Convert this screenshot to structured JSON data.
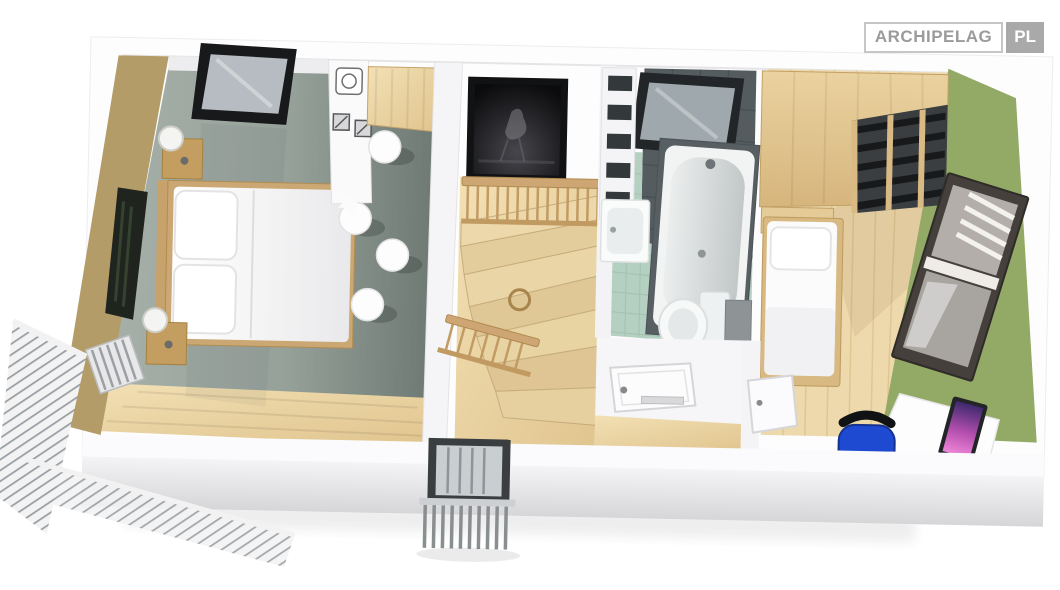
{
  "logo": {
    "brand": "ARCHIPELAG",
    "tld": "PL"
  },
  "palette": {
    "white_wall": "#fbfbfc",
    "tan_wall": "#b49c69",
    "olive_wall": "#93a966",
    "carpet_grey": "#8f9a93",
    "pine_wood": "#e8d2a2",
    "bath_floor_mint": "#b4d0c1",
    "bath_tile_dark": "#545c5f",
    "skylight_frame": "#17191b",
    "chair_blue": "#1d4ad1",
    "screen_pink": "#c45ab8",
    "logo_text_grey": "#9b9b9b",
    "logo_badge_grey": "#a9a9a9"
  },
  "scene": {
    "type": "3d-floorplan-cutaway-render",
    "view": "top-down, slight clockwise tilt",
    "rooms": [
      {
        "id": "bedroom-left",
        "label": "bedroom with dining nook",
        "objects": [
          "double bed",
          "two nightstands with lamps",
          "wall art",
          "radiator",
          "kitchenette counter with sink and hob",
          "wooden wall table",
          "white stools",
          "roof skylight",
          "grey carpet",
          "pine floor border"
        ]
      },
      {
        "id": "stair-hall",
        "label": "landing with winder staircase",
        "objects": [
          "framed artwork",
          "wooden railing",
          "winder stairs",
          "glazed balcony door"
        ]
      },
      {
        "id": "bathroom",
        "label": "bathroom",
        "objects": [
          "bathtub",
          "washbasin",
          "toilet",
          "towel shelf",
          "roof skylight",
          "mint floor tiles",
          "dark wall tiles",
          "door"
        ]
      },
      {
        "id": "bedroom-right",
        "label": "bedroom / study",
        "objects": [
          "wardrobe with open shelves",
          "single bed",
          "tilted window with blinds",
          "desk with monitor",
          "blue office chair",
          "door"
        ]
      }
    ],
    "exterior": [
      "white perimeter walls",
      "corner balcony with slatted railing",
      "juliet balcony railing",
      "soft drop shadow"
    ]
  }
}
